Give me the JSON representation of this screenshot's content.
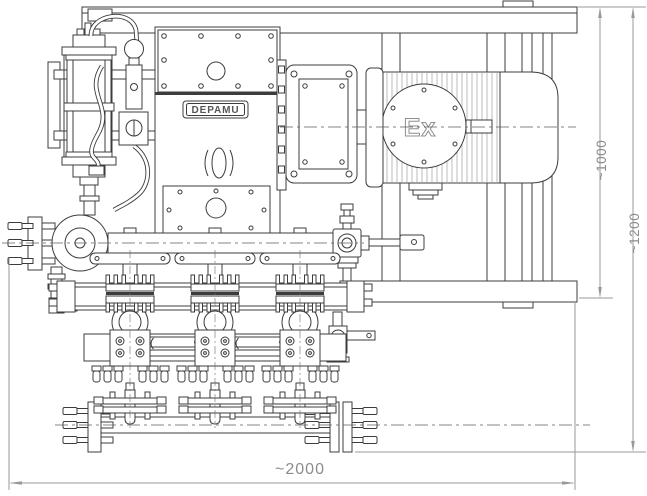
{
  "drawing": {
    "brand_label": "DEPAMU",
    "motor_label": "Ex",
    "dimensions": {
      "height_to_frame": "~1000",
      "height_total": "~1200",
      "width_total": "~2000"
    },
    "colors": {
      "line": "#3c3c3c",
      "dimension_line": "#9a9a9a",
      "dimension_text": "#8c8c8c",
      "logo_text": "#565656",
      "background": "#ffffff"
    }
  }
}
